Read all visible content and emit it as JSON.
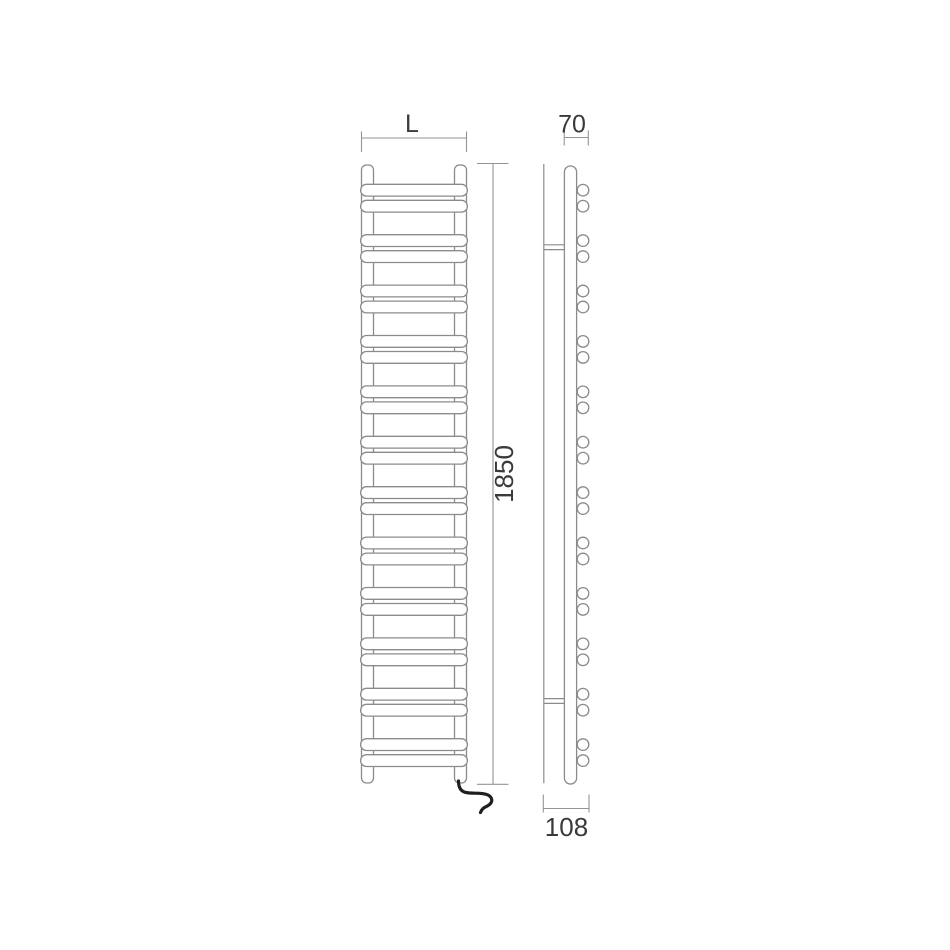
{
  "drawing": {
    "type": "towel-radiator-technical-drawing",
    "front_view": {
      "width_dimension_label": "L",
      "height_dimension_label": "1850",
      "bar_pairs": 12,
      "bars_total": 24
    },
    "side_view": {
      "depth_dimension_label": "70",
      "total_depth_dimension_label": "108",
      "tube_end_pairs": 12,
      "tube_ends_total": 24,
      "wall_brackets": 2
    }
  },
  "colors": {
    "background": "#ffffff",
    "line": "#8b8b8b",
    "dimension": "#949494",
    "text": "#3a3a3a",
    "cable": "#1f1f1f"
  },
  "geometry": {
    "front": {
      "bar_x": 360.6,
      "bar_width": 106.8,
      "bar_height": 11.8,
      "bar_radius": 5.9,
      "pair_count": 12,
      "first_pair_y": 184.3,
      "pair_pitch": 50.4,
      "second_bar_offset": 16
    },
    "side": {
      "tube_cx": 583,
      "tube_radius": 5.8,
      "pair_count": 12,
      "first_pair_cy": 190.2,
      "pair_pitch": 50.4,
      "second_tube_offset": 16
    }
  }
}
